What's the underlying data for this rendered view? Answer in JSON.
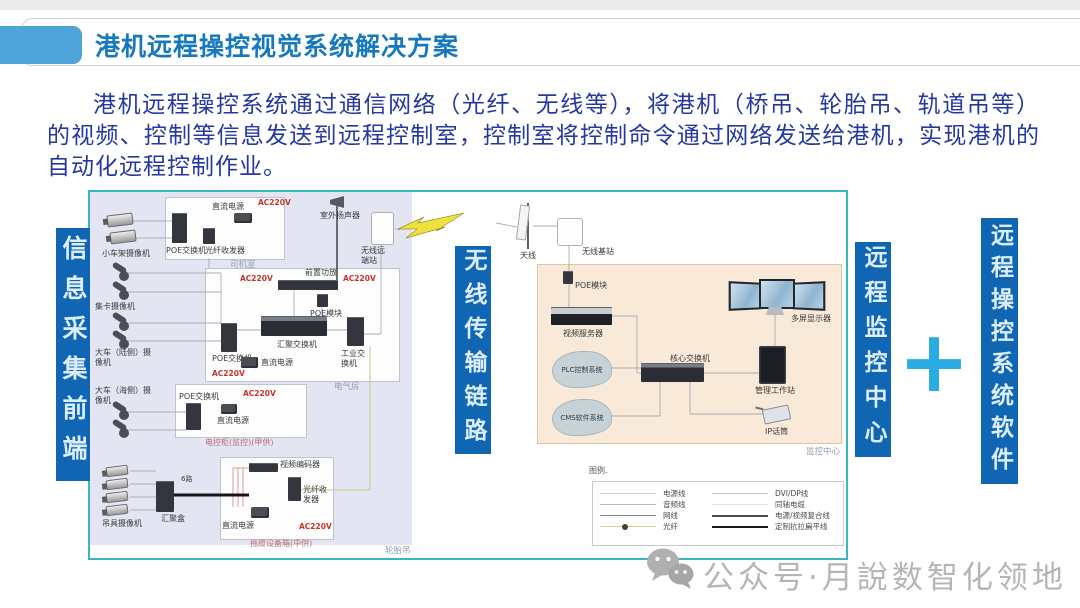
{
  "slide": {
    "title": "港机远程操控视觉系统解决方案"
  },
  "intro": {
    "text": "港机远程操控系统通过通信网络（光纤、无线等），将港机（桥吊、轮胎吊、轨道吊等）的视频、控制等信息发送到远程控制室，控制室将控制命令通过网络发送给港机，实现港机的自动化远程控制作业。"
  },
  "colors": {
    "accent_blue": "#1066b2",
    "title_blue": "#1678bd",
    "tab_blue": "#4ea3d9",
    "body_text_blue": "#2438a0",
    "plus_cyan": "#2aabe4",
    "frame_teal": "#3bb6bd",
    "ac_red": "#c3342b"
  },
  "side_labels": {
    "front_end": "信息采集前端",
    "wireless_link": "无线传输链路",
    "monitor_center": "远程监控中心",
    "plus": "+",
    "software": "远程操控系统软件"
  },
  "field": {
    "cameras": {
      "trolley": "小车架摄像机",
      "truck": "集卡摄像机",
      "gantry_land": "大车（陆侧）摄像机",
      "gantry_sea": "大车（海侧）摄像机",
      "spreader": "吊具摄像机"
    },
    "cab": {
      "tag": "司机室",
      "poe_switch": "POE交换机",
      "fiber_transceiver": "光纤收发器",
      "dc_power": "直流电源",
      "ac": "AC220V"
    },
    "elec_room": {
      "tag": "电气房",
      "preamp": "前置功放",
      "ac1": "AC220V",
      "ac2": "AC220V",
      "poe_module": "POE模块",
      "agg_switch": "汇聚交换机",
      "ind_switch": "工业交换机",
      "poe_switch": "POE交换机",
      "dc_power": "直流电源",
      "ac3": "AC220V"
    },
    "outdoor_speaker": "室外扬声器",
    "wireless_remote_station": "无线远端站",
    "ctrl_cabinet": {
      "tag": "电控柜(监控)(甲供)",
      "poe_switch": "POE交换机",
      "dc_power": "直流电源",
      "ac": "AC220V"
    },
    "cable_box": {
      "tag": "拖缆设备箱(中供)",
      "encoder": "视频编码器",
      "fiber_transceiver": "光纤收发器",
      "dc_power": "直流电源",
      "ac": "AC220V"
    },
    "junction_box": "汇聚盒",
    "line_tag": "6路",
    "crane_tag": "轮胎吊"
  },
  "link": {
    "antenna": "天线",
    "base_station": "无线基站"
  },
  "monitor_room": {
    "tag": "监控中心",
    "poe_module": "POE模块",
    "video_server": "视频服务器",
    "plc_cloud": "PLC控制系统",
    "cms_cloud": "CMS软件系统",
    "core_switch": "核心交换机",
    "multi_display": "多屏显示器",
    "workstation": "管理工作站",
    "ip_mic": "IP话筒"
  },
  "legend": {
    "title": "图例.",
    "left": [
      "电源线",
      "音频线",
      "网线",
      "光纤"
    ],
    "right": [
      "DVI/DP线",
      "同轴电缆",
      "电源/视频复合线",
      "定制抗拉扁平线"
    ]
  },
  "watermark": {
    "text": "公众号·月說数智化领地"
  }
}
